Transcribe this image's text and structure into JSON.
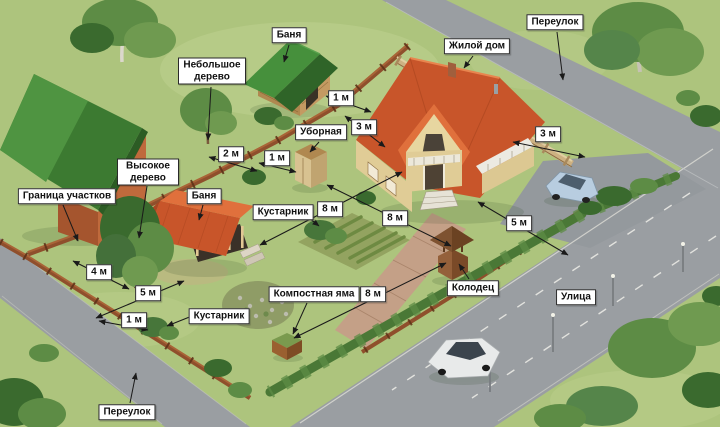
{
  "colors": {
    "grass": "#adc47d",
    "grass-light": "#cddc9e",
    "road": "#9a9ea2",
    "road-line": "#e2e2de",
    "roof-red": "#c8552a",
    "roof-red-light": "#e0703c",
    "roof-green": "#46903c",
    "roof-green-dark": "#2f6428",
    "wall-brick": "#bf6a3c",
    "wall-cream": "#e7d6a0",
    "wall-log": "#c49a62",
    "fence-brown": "#8f4f2c",
    "fence-light": "#cdb182",
    "hedge": "#4a7836",
    "tree-dark": "#3a6a2e",
    "tree-mid": "#5d8c45",
    "tree-light": "#6f9a50",
    "label-bg": "#ffffff",
    "label-border": "#2a2a2a",
    "label-text": "#111111",
    "line": "#1a1a1a"
  },
  "labels": {
    "banya_top": "Баня",
    "small_tree": "Небольшое дерево",
    "dwelling_house": "Жилой дом",
    "lane_top": "Переулок",
    "outhouse": "Уборная",
    "tall_tree": "Высокое дерево",
    "plot_boundary": "Граница участков",
    "banya_left": "Баня",
    "shrub_upper": "Кустарник",
    "well": "Колодец",
    "street": "Улица",
    "shrub_lower": "Кустарник",
    "compost_pit": "Компостная яма",
    "lane_bottom": "Переулок"
  },
  "distances": {
    "neighbor_banya_to_fence": "1 м",
    "fence_to_house": "3 м",
    "house_to_lane_fence": "3 м",
    "small_tree_to_fence": "2 м",
    "fence_to_outhouse": "1 м",
    "banya_to_house": "8 м",
    "outhouse_to_well": "8 м",
    "compost_to_well": "8 м",
    "house_to_street_fence": "5 м",
    "tall_tree_to_fence": "4 м",
    "banya_to_lane_fence": "5 м",
    "shrub_to_fence": "1 м"
  }
}
